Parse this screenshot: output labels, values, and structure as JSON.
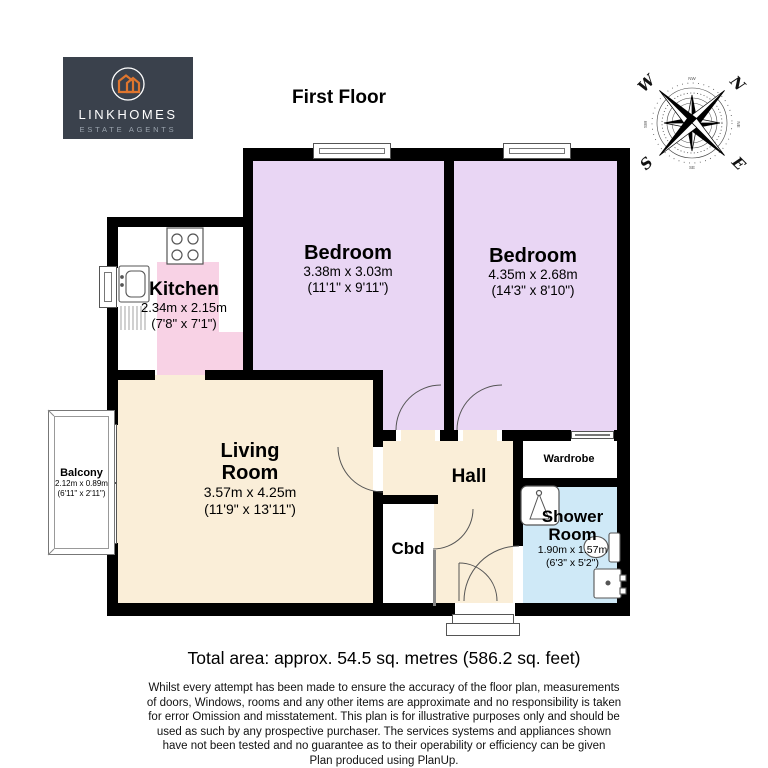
{
  "title": "First Floor",
  "logo": {
    "brand": "LINKHOMES",
    "tagline": "ESTATE AGENTS",
    "bg_color": "#3a414c",
    "accent_color": "#e0762e"
  },
  "compass": {
    "n": "N",
    "e": "E",
    "s": "S",
    "w": "W",
    "minor": [
      "NW",
      "NE",
      "SE",
      "SW"
    ]
  },
  "rooms": {
    "kitchen": {
      "name": "Kitchen",
      "dims_m": "2.34m x 2.15m",
      "dims_ft": "(7'8\" x 7'1\")"
    },
    "bedroom1": {
      "name": "Bedroom",
      "dims_m": "3.38m x 3.03m",
      "dims_ft": "(11'1\" x 9'11\")"
    },
    "bedroom2": {
      "name": "Bedroom",
      "dims_m": "4.35m x 2.68m",
      "dims_ft": "(14'3\" x 8'10\")"
    },
    "living": {
      "name_line1": "Living",
      "name_line2": "Room",
      "dims_m": "3.57m x 4.25m",
      "dims_ft": "(11'9\" x 13'11\")"
    },
    "hall": {
      "name": "Hall"
    },
    "cbd": {
      "name": "Cbd"
    },
    "wardrobe": {
      "name": "Wardrobe"
    },
    "shower": {
      "name_line1": "Shower",
      "name_line2": "Room",
      "dims_m": "1.90m x 1.57m",
      "dims_ft": "(6'3\" x 5'2\")"
    },
    "balcony": {
      "name": "Balcony",
      "dims_m": "2.12m x 0.89m",
      "dims_ft": "(6'11\" x 2'11\")"
    }
  },
  "footer": {
    "total_area": "Total area: approx. 54.5 sq. metres (586.2 sq. feet)",
    "disclaimer": [
      "Whilst every attempt has been made to ensure the accuracy of the floor plan, measurements",
      "of doors, Windows, rooms and any other items are approximate and no responsibility is taken",
      "for error Omission and misstatement. This plan is for illustrative purposes only and should be",
      "used as such by any prospective purchaser. The services systems and appliances shown",
      "have not been tested and no guarantee as to their operability or efficiency can be given",
      "Plan produced using PlanUp."
    ]
  },
  "colors": {
    "wall": "#000000",
    "bedroom_floor": "#e9d6f4",
    "kitchen_counter": "#f8d2e5",
    "living_floor": "#faeed8",
    "shower_floor": "#cfe9f7",
    "white_floor": "#ffffff"
  }
}
